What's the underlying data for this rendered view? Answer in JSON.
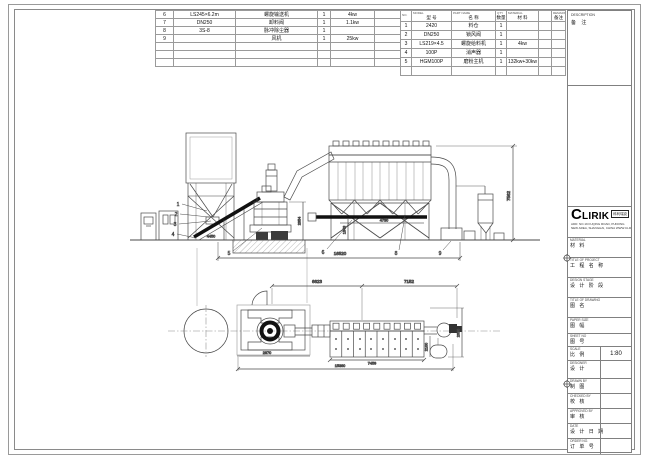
{
  "parts_left": {
    "rows": [
      [
        "6",
        "LS245×6.2m",
        "螺旋输送机",
        "1",
        "4kw",
        ""
      ],
      [
        "7",
        "DN250",
        "卸料阀",
        "1",
        "1.1kw",
        ""
      ],
      [
        "8",
        "3S-8",
        "脉冲除尘器",
        "1",
        "",
        ""
      ],
      [
        "9",
        "",
        "风机",
        "1",
        "25kw",
        ""
      ],
      [
        "",
        "",
        "",
        "",
        "",
        ""
      ],
      [
        "",
        "",
        "",
        "",
        "",
        ""
      ],
      [
        "",
        "",
        "",
        "",
        "",
        ""
      ]
    ]
  },
  "parts_right": {
    "header": [
      {
        "en": "NO.",
        "cn": ""
      },
      {
        "en": "MODEL",
        "cn": "型  号"
      },
      {
        "en": "PART NAME",
        "cn": "名  称"
      },
      {
        "en": "QTY",
        "cn": "数量"
      },
      {
        "en": "MATERIAL",
        "cn": "材  料"
      },
      {
        "en": "",
        "cn": ""
      },
      {
        "en": "REMARK",
        "cn": "备注"
      }
    ],
    "rows": [
      [
        "1",
        "2420",
        "料仓",
        "1",
        "",
        "",
        ""
      ],
      [
        "2",
        "DN250",
        "锁风阀",
        "1",
        "",
        "",
        ""
      ],
      [
        "3",
        "LS219×4.5",
        "螺旋给料机",
        "1",
        "4kw",
        "",
        ""
      ],
      [
        "4",
        "100P",
        "消声器",
        "1",
        "",
        "",
        ""
      ],
      [
        "5",
        "HGM100P",
        "磨粉主机",
        "1",
        "132kw+30kw",
        "",
        ""
      ],
      [
        "",
        "",
        "",
        "",
        "",
        "",
        ""
      ]
    ]
  },
  "description_box": {
    "en": "DESCRIPTION",
    "cn": "备  注"
  },
  "logo": {
    "brand_c": "C",
    "brand_rest": "LIRIK",
    "brand_cn": "科利瑞克",
    "address1": "ADD: NO.19 FUQING ROAD, PUDONG",
    "address2": "NEW AREA, SHANGHAI, CHINA  WWW.CLIRIK.COM"
  },
  "titleblock": {
    "rows": [
      {
        "en": "MATERIAL",
        "cn": "材  料",
        "value": ""
      },
      {
        "en": "TITLE OF PROJECT",
        "cn": "工 程 名 称",
        "value": ""
      },
      {
        "en": "DESIGN STAGE",
        "cn": "设 计 阶 段",
        "value": ""
      },
      {
        "en": "TITLE OF DRAWING",
        "cn": "图    名",
        "value": ""
      },
      {
        "en": "PAPER SIZE",
        "cn": "图  幅",
        "value": ""
      },
      {
        "en": "SHEET NO",
        "cn": "图  号",
        "value": ""
      },
      {
        "en": "SCALE",
        "cn": "比  例",
        "value": "1:80"
      },
      {
        "en": "DESIGNER",
        "cn": "设  计",
        "value": ""
      },
      {
        "en": "DRAWN BY",
        "cn": "制  图",
        "value": ""
      },
      {
        "en": "CHECKED BY",
        "cn": "校  核",
        "value": ""
      },
      {
        "en": "APPROVED BY",
        "cn": "审  核",
        "value": ""
      },
      {
        "en": "DATE",
        "cn": "设 计 日 期",
        "value": ""
      },
      {
        "en": "ORDER NO.",
        "cn": "订 单 号",
        "value": ""
      }
    ]
  },
  "drawing": {
    "dims": {
      "elev_height": "7562",
      "elev_total": "16520",
      "elev_mill_h": "2354",
      "elev_screw_h": "1343",
      "elev_hopper_w": "4730",
      "elev_silo_w": "4450",
      "plan_left": "6623",
      "plan_right": "7152",
      "plan_baghouse": "7459",
      "plan_total": "15360",
      "plan_mill": "2870",
      "plan_depth": "2630",
      "plan_duct": "2100"
    },
    "balloons_left": [
      "1",
      "2",
      "3",
      "4"
    ],
    "balloons_bottom": [
      "5",
      "6",
      "8",
      "9"
    ]
  }
}
